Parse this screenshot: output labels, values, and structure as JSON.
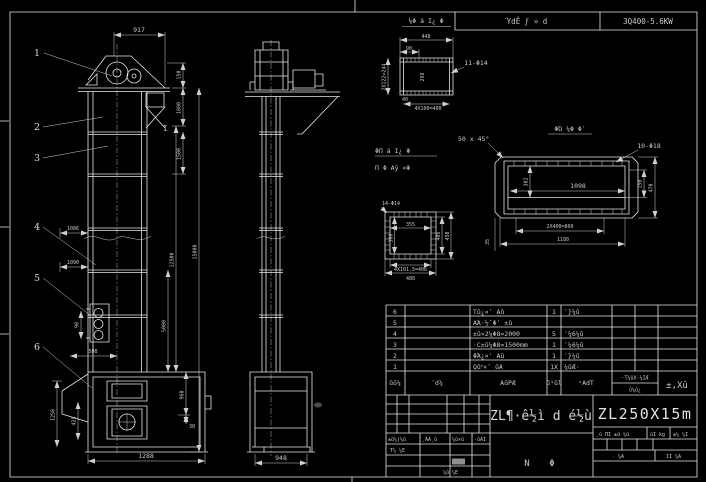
{
  "colors": {
    "background": "#000000",
    "line": "#e8e8e8",
    "dim_text": "#c9c9c9",
    "highlight_cell": "#8f8f8f"
  },
  "header": {
    "left_cell": "ΎdÊ ϝ » d",
    "right_cell": "3Q400-5.6KW"
  },
  "fv": {
    "balloons": [
      "1",
      "2",
      "3",
      "4",
      "5",
      "6"
    ],
    "section_mark": "I",
    "d917": "917",
    "d150": "150",
    "d1080": "1080",
    "d1500": "1500",
    "d12500": "12500",
    "d15000": "15000",
    "d5000": "5000",
    "d960": "960",
    "d30": "30",
    "d1086": "1086",
    "d1090": "1090",
    "d90": "90",
    "d508": "508",
    "d1250": "1250",
    "d425": "425",
    "d1288": "1288"
  },
  "sv": {
    "d948": "948"
  },
  "da": {
    "title": "⅛Φ á Ι¿ Φ",
    "d448": "448",
    "d90": "90",
    "left": "2X122=244",
    "inner": "298",
    "d40": "40",
    "bottom": "4X100=400",
    "holes": "11-Φ14"
  },
  "db": {
    "title1": "ΦΠ á Ι¿ Φ",
    "title2": "Π Φ Αÿ ×Φ",
    "holes": "14-Φ14",
    "inner_w": "355",
    "inner_h": "300",
    "right_in": "406",
    "right_out": "450",
    "bot_in": "4X101.5=406",
    "bot_out": "480"
  },
  "dc": {
    "title": "ΦΏ ¼Φ Φʹ",
    "chamfer": "50 x 45°",
    "holes": "10-Φ18",
    "inner_w": "1098",
    "inner_h": "302",
    "right_in": "150",
    "right_out": "470",
    "bot_in": "2X400=800",
    "bot_mid": "1180",
    "left": "35"
  },
  "bom": {
    "rows": [
      {
        "no": "6",
        "name": "Τû¿×ʹ Αû",
        "qty": "1",
        "mat": "ʹ}¼û"
      },
      {
        "no": "5",
        "name": "ΑΆ·½ˇΦʹ ±û",
        "qty": "",
        "mat": ""
      },
      {
        "no": "4",
        "name": "±û×2¼Φ8=2000",
        "qty": "5",
        "mat": "ʹ¼6¼û"
      },
      {
        "no": "3",
        "name": "·C±û¼Φ8=1500mm",
        "qty": "1",
        "mat": "ʹ¼6¼û"
      },
      {
        "no": "2",
        "name": "ΦΆ¿×ʹ Αû",
        "qty": "1",
        "mat": "ʹ}¼û"
      },
      {
        "no": "1",
        "name": "Qûʺ×ʹ ûΑ",
        "qty": "1X",
        "mat": "¼ûÆ·"
      }
    ],
    "footer": {
      "no": "ûû¼",
      "code": "ʹd¼",
      "name": "ΑûΡÆ",
      "qty": "û¹ûl",
      "mat": "ˣΑdΤ",
      "weight_top": "·Τ¼ûX·¼ΙÆ",
      "weight_bottom": "û¼û¿",
      "remark": "±,Xû"
    }
  },
  "tb": {
    "rev_header": [
      "±û¼|¼û",
      "¸ΆΑ¸û",
      "¼û×û",
      "·ûΑΙ"
    ],
    "row2_label": "Τ¼ ¼Ε",
    "bottom_label": "¼û ¼Ε",
    "main_title": "ZL¶·ê½ì d é½ù",
    "sheet_left": "Ν",
    "sheet_right": "Φ",
    "model": "ZL250X15m",
    "right_header": [
      "¸û ΠΙ ±û ¼û",
      "ûΙ kg",
      "±¼ ¼Ι"
    ],
    "sheet_row": [
      "· ¼Α",
      "ΙΙ ¼Α"
    ]
  }
}
